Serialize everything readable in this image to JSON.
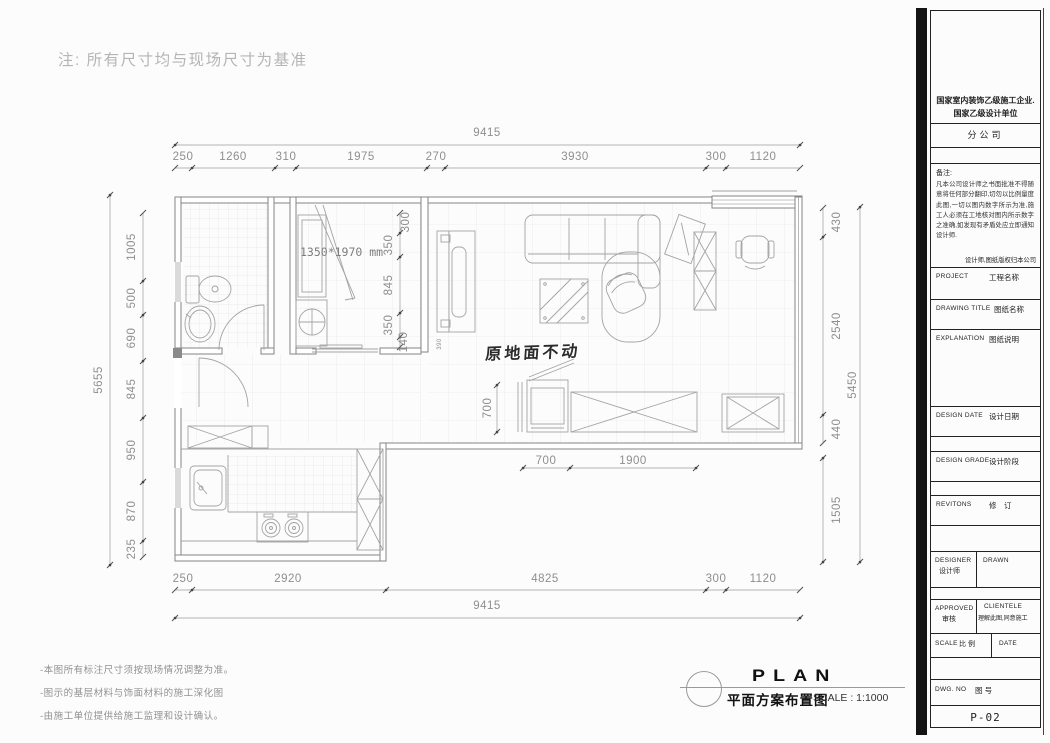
{
  "note_top": "注: 所有尺寸均与现场尺寸为基准",
  "plan": {
    "dims_top": {
      "total": "9415",
      "segments": [
        "250",
        "1260",
        "310",
        "1975",
        "270",
        "3930",
        "300",
        "1120"
      ]
    },
    "dims_bottom": {
      "total": "9415",
      "segments": [
        "250",
        "2920",
        "4825",
        "300",
        "1120"
      ]
    },
    "dims_left": {
      "total": "5655",
      "segments": [
        "1005",
        "500",
        "690",
        "845",
        "950",
        "870",
        "235"
      ]
    },
    "dims_right": {
      "total": "5450",
      "segments": [
        "430",
        "2540",
        "440",
        "1505"
      ]
    },
    "dims_inner": {
      "chain": [
        "300",
        "350",
        "845",
        "350",
        "140"
      ],
      "closet": "390",
      "tv": "700",
      "floor": [
        "700",
        "1900"
      ]
    },
    "labels": {
      "shower_size": "1350*1970 mm",
      "floor_note": "原地面不动"
    }
  },
  "footer_notes": [
    "-本图所有标注尺寸须按现场情况调整为准。",
    "-图示的基层材料与饰面材料的施工深化图",
    "-由施工单位提供给施工监理和设计确认。"
  ],
  "caption": {
    "title_en": "PLAN",
    "title_zh": "平面方案布置图",
    "scale": "SCALE : 1:1000"
  },
  "titleblock": {
    "company_line1": "国家室内装饰乙级施工企业.",
    "company_line2": "国家乙级设计单位",
    "branch": "分公司",
    "remark_label": "备注:",
    "remark_body": "凡本公司设计师之书面批准不得随意将任何部分翻印,切勿以比例量度此图,一切以图内数字所示为准,施工人必须在工地核对图内所示数字之准确,如发现有矛盾处应立即通知设计师.",
    "copyright": "设计师,图纸版权归本公司",
    "project_en": "PROJECT",
    "project_zh": "工程名称",
    "drawing_title_en": "DRAWING TITLE",
    "drawing_title_zh": "图纸名称",
    "explanation_en": "EXPLANATION",
    "explanation_zh": "图纸说明",
    "design_date_en": "DESIGN DATE",
    "design_date_zh": "设计日期",
    "design_grade_en": "DESIGN GRADE",
    "design_grade_zh": "设计阶段",
    "revisions_en": "REVITONS",
    "revisions_zh": "修　订",
    "designer_en": "DESIGNER",
    "designer_zh": "设计师",
    "drawn_en": "DRAWN",
    "approved_en": "APPROVED",
    "approved_zh": "审核",
    "clientele_en": "CLIENTELE",
    "clientele_zh": "理解此图,同意施工",
    "scale_en": "SCALE",
    "scale_zh": "比 例",
    "date_en": "DATE",
    "dwg_en": "DWG. NO",
    "dwg_zh": "图 号",
    "dwg_no": "P-02"
  },
  "colors": {
    "wall": "#858585",
    "furniture": "#a3a3a3",
    "dim_line": "#9b9b9b",
    "dim_text": "#8e8e8e",
    "ink": "#1a1a1a"
  }
}
